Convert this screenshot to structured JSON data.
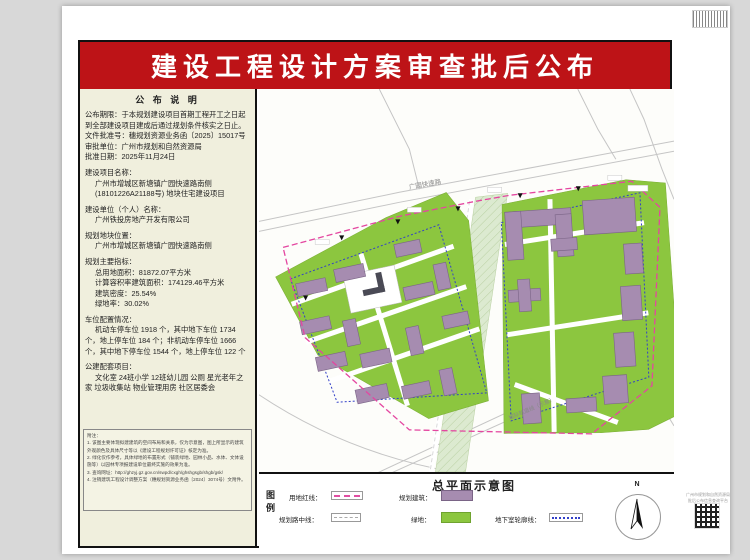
{
  "page": {
    "title": "建设工程设计方案审查批后公布"
  },
  "notice": {
    "heading": "公 布 说 明",
    "period": "公布期限：于本规划建设项目首期工程开工之日起到全部建设项目建成后通过规划条件核实之日止。",
    "doc_no": "文件批准号：穗规划资源业务函〔2025〕15017号",
    "authority": "审批单位：广州市规划和自然资源局",
    "approval_date": "批准日期：2025年11月24日"
  },
  "project": {
    "name_label": "建设项目名称：",
    "name_line1": "广州市增城区新塘镇广园快速路南侧",
    "name_line2": "(18101226A21188号) 地块住宅建设项目",
    "unit_label": "建设单位（个人）名称：",
    "unit_name": "广州铁投房地产开发有限公司",
    "location_label": "规划地块位置：",
    "location": "广州市增城区新塘镇广园快速路南侧",
    "indicators_label": "规划主要指标：",
    "indicators": [
      "总用地面积：81872.07平方米",
      "计算容积率建筑面积：174129.46平方米",
      "建筑密度：25.54%",
      "绿地率：30.02%"
    ],
    "parking_label": "车位配置情况：",
    "parking_text": "机动车停车位 1918 个，其中地下车位 1734个，地上停车位 184 个；非机动车停车位 1666 个，其中地下停车位 1544 个，地上停车位 122 个",
    "facilities_label": "公建配套项目：",
    "facilities_text": "文化室 24班小学 12班幼儿园 公厕 星光老年之家 垃圾收集站 物业管理用房 社区居委会"
  },
  "notes": {
    "heading": "附注：",
    "items": [
      "1. 该图主要体现拟建建筑的空间布局和关系，仅为示意图，图上所显示的建筑外观颜色及具体尺寸等以《建设工程规划许可证》核定为准。",
      "2. 绿化仅作参考，具体绿地的布置形式（铺装绿地、园林小品、水体、文体设施等）以园林专项报建设单位最终实施的效果为准。",
      "3. 查询网址：http://ghzyj.gz.gov.cn/swpd/cxgh/ghshgsgb/shgb/gsk/",
      "4. 注销建筑工程设计调整方案（穗规划资源业务函〔2024〕3074号）文附件。"
    ]
  },
  "map": {
    "title": "总平面示意图",
    "top_road_label": "广园快速路",
    "rail_label": "城际轨道线（示意）"
  },
  "legend": {
    "key_label": "图例",
    "north_label": "N",
    "items": [
      {
        "name": "用地红线："
      },
      {
        "name": "规划建筑："
      },
      {
        "name": "规划路中线："
      },
      {
        "name": "绿地："
      },
      {
        "name": "地下室轮廓线："
      }
    ]
  },
  "footer": {
    "qr_caption_line1": "广州市规划和自然资源局",
    "qr_caption_line2": "批后公布信息查询平台"
  },
  "colors": {
    "banner_red": "#bd1317",
    "panel_cream": "#f0efdd",
    "building_purple": "#a68cb0",
    "green": "#8cc63f",
    "boundary_pink": "#e446a0",
    "underground_blue": "#3340c8"
  }
}
